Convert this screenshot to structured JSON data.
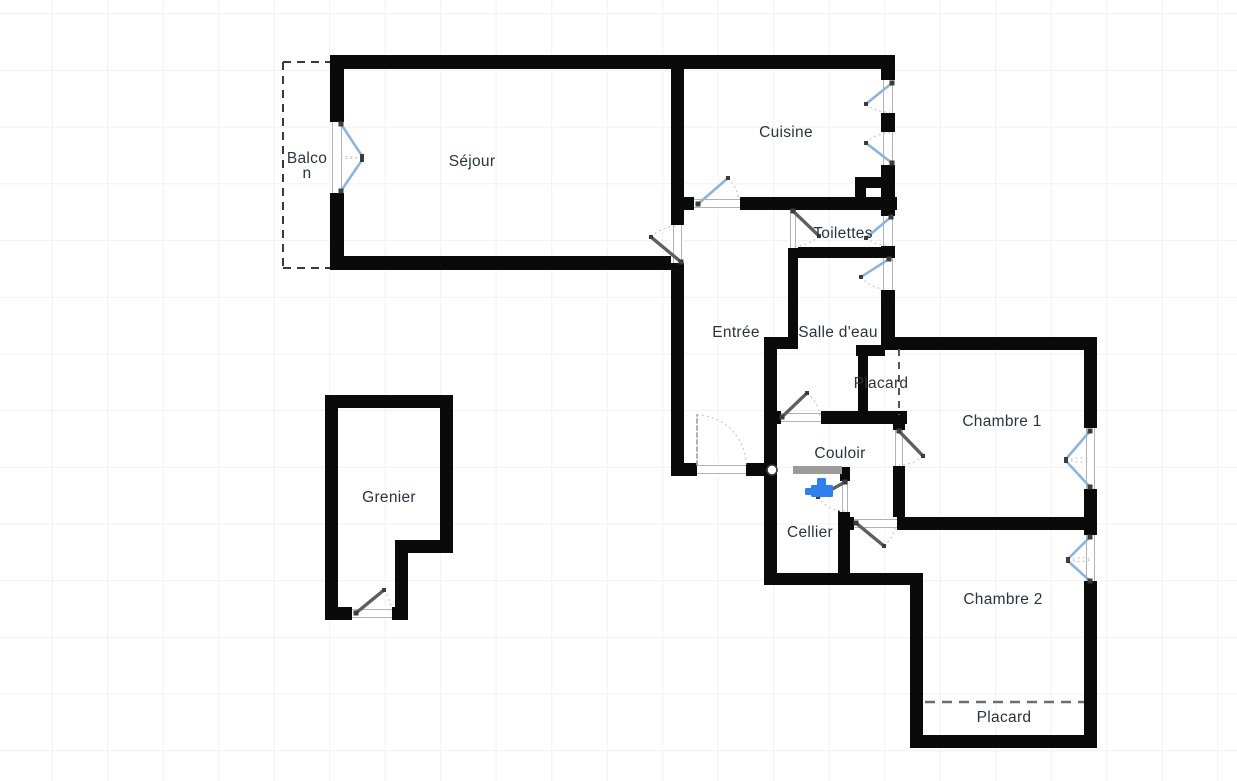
{
  "canvas": {
    "width": 1237,
    "height": 781,
    "background": "#ffffff",
    "grid_color": "#f1f1f1"
  },
  "colors": {
    "wall": "#0a0a0a",
    "door_leaf": "#5c6064",
    "window_leaf": "#8fb3dc",
    "entry_leaf": "#9aa0a6",
    "arc": "#c9c9c9",
    "opening_frame": "#b3b3b3",
    "label": "#28343f",
    "passage_bar": "#9b9b9b",
    "fixture_blue": "#2f80ed",
    "dashed": "#3a3a3a",
    "placard_dash": "#6e6e6e"
  },
  "rooms": [
    {
      "id": "balcon",
      "lines": [
        "Balco",
        "n"
      ],
      "x": 307,
      "y": 163
    },
    {
      "id": "sejour",
      "lines": [
        "Séjour"
      ],
      "x": 472,
      "y": 166
    },
    {
      "id": "cuisine",
      "lines": [
        "Cuisine"
      ],
      "x": 786,
      "y": 137
    },
    {
      "id": "toilettes",
      "lines": [
        "Toilettes"
      ],
      "x": 843,
      "y": 238
    },
    {
      "id": "entree",
      "lines": [
        "Entrée"
      ],
      "x": 736,
      "y": 337
    },
    {
      "id": "salle-d-eau",
      "lines": [
        "Salle d'eau"
      ],
      "x": 838,
      "y": 337
    },
    {
      "id": "placard-1",
      "lines": [
        "Placard"
      ],
      "x": 881,
      "y": 388
    },
    {
      "id": "chambre-1",
      "lines": [
        "Chambre 1"
      ],
      "x": 1002,
      "y": 426
    },
    {
      "id": "couloir",
      "lines": [
        "Couloir"
      ],
      "x": 840,
      "y": 458
    },
    {
      "id": "cellier",
      "lines": [
        "Cellier"
      ],
      "x": 810,
      "y": 537
    },
    {
      "id": "chambre-2",
      "lines": [
        "Chambre 2"
      ],
      "x": 1003,
      "y": 604
    },
    {
      "id": "grenier",
      "lines": [
        "Grenier"
      ],
      "x": 389,
      "y": 502
    },
    {
      "id": "placard-2",
      "lines": [
        "Placard"
      ],
      "x": 1004,
      "y": 722
    }
  ],
  "walls": [
    {
      "x": 330,
      "y": 55,
      "w": 565,
      "h": 14
    },
    {
      "x": 330,
      "y": 55,
      "w": 14,
      "h": 69
    },
    {
      "x": 330,
      "y": 191,
      "w": 14,
      "h": 79
    },
    {
      "x": 330,
      "y": 256,
      "w": 354,
      "h": 14
    },
    {
      "x": 671,
      "y": 55,
      "w": 13,
      "h": 172
    },
    {
      "x": 671,
      "y": 261,
      "w": 13,
      "h": 215
    },
    {
      "x": 671,
      "y": 463,
      "w": 106,
      "h": 13
    },
    {
      "x": 881,
      "y": 55,
      "w": 14,
      "h": 295
    },
    {
      "x": 684,
      "y": 197,
      "w": 213,
      "h": 13
    },
    {
      "x": 855,
      "y": 177,
      "w": 30,
      "h": 11
    },
    {
      "x": 855,
      "y": 177,
      "w": 11,
      "h": 33
    },
    {
      "x": 788,
      "y": 247,
      "w": 97,
      "h": 11
    },
    {
      "x": 788,
      "y": 210,
      "w": 10,
      "h": 130
    },
    {
      "x": 764,
      "y": 337,
      "w": 34,
      "h": 12
    },
    {
      "x": 764,
      "y": 343,
      "w": 13,
      "h": 242
    },
    {
      "x": 777,
      "y": 411,
      "w": 130,
      "h": 13
    },
    {
      "x": 858,
      "y": 347,
      "w": 10,
      "h": 70
    },
    {
      "x": 856,
      "y": 345,
      "w": 29,
      "h": 11
    },
    {
      "x": 883,
      "y": 337,
      "w": 214,
      "h": 13
    },
    {
      "x": 893,
      "y": 417,
      "w": 12,
      "h": 113
    },
    {
      "x": 1084,
      "y": 337,
      "w": 13,
      "h": 411
    },
    {
      "x": 897,
      "y": 517,
      "w": 200,
      "h": 13
    },
    {
      "x": 846,
      "y": 517,
      "w": 8,
      "h": 13
    },
    {
      "x": 840,
      "y": 467,
      "w": 10,
      "h": 16
    },
    {
      "x": 838,
      "y": 510,
      "w": 12,
      "h": 63
    },
    {
      "x": 764,
      "y": 573,
      "w": 159,
      "h": 12
    },
    {
      "x": 910,
      "y": 573,
      "w": 13,
      "h": 175
    },
    {
      "x": 910,
      "y": 735,
      "w": 187,
      "h": 13
    },
    {
      "x": 325,
      "y": 395,
      "w": 128,
      "h": 13
    },
    {
      "x": 325,
      "y": 395,
      "w": 13,
      "h": 225
    },
    {
      "x": 440,
      "y": 395,
      "w": 13,
      "h": 158
    },
    {
      "x": 395,
      "y": 540,
      "w": 58,
      "h": 13
    },
    {
      "x": 395,
      "y": 540,
      "w": 13,
      "h": 80
    },
    {
      "x": 325,
      "y": 607,
      "w": 73,
      "h": 13
    }
  ],
  "openings": [
    {
      "name": "balcony-door-opening",
      "x": 330,
      "y": 122,
      "w": 14,
      "h": 71,
      "dir": "v"
    },
    {
      "name": "sejour-door-opening",
      "x": 671,
      "y": 225,
      "w": 13,
      "h": 38,
      "dir": "v"
    },
    {
      "name": "entry-door-opening",
      "x": 697,
      "y": 463,
      "w": 49,
      "h": 13,
      "dir": "h"
    },
    {
      "name": "cuisine-door-opening",
      "x": 694,
      "y": 197,
      "w": 46,
      "h": 13,
      "dir": "h"
    },
    {
      "name": "toilettes-door-opening",
      "x": 788,
      "y": 210,
      "w": 10,
      "h": 38,
      "dir": "v"
    },
    {
      "name": "couloir-door-opening",
      "x": 781,
      "y": 411,
      "w": 40,
      "h": 13,
      "dir": "h"
    },
    {
      "name": "cellier-door-opening",
      "x": 840,
      "y": 481,
      "w": 10,
      "h": 31,
      "dir": "v"
    },
    {
      "name": "chambre1-door-opening",
      "x": 893,
      "y": 430,
      "w": 12,
      "h": 36,
      "dir": "v"
    },
    {
      "name": "chambre2-door-opening",
      "x": 854,
      "y": 517,
      "w": 43,
      "h": 13,
      "dir": "h"
    },
    {
      "name": "grenier-door-opening",
      "x": 352,
      "y": 607,
      "w": 40,
      "h": 13,
      "dir": "h"
    },
    {
      "name": "cuisine-window-1-opening",
      "x": 881,
      "y": 80,
      "w": 14,
      "h": 33,
      "dir": "v"
    },
    {
      "name": "cuisine-window-2-opening",
      "x": 881,
      "y": 132,
      "w": 14,
      "h": 33,
      "dir": "v"
    },
    {
      "name": "toilettes-window-opening",
      "x": 881,
      "y": 216,
      "w": 14,
      "h": 30,
      "dir": "v"
    },
    {
      "name": "salle-d-eau-window-opening",
      "x": 881,
      "y": 258,
      "w": 14,
      "h": 32,
      "dir": "v"
    },
    {
      "name": "chambre1-window-opening",
      "x": 1084,
      "y": 428,
      "w": 13,
      "h": 61,
      "dir": "v"
    },
    {
      "name": "chambre2-window-opening",
      "x": 1084,
      "y": 535,
      "w": 13,
      "h": 46,
      "dir": "v"
    }
  ],
  "doors": [
    {
      "name": "sejour-door",
      "kind": "door",
      "leaf": [
        681,
        262,
        651,
        237
      ],
      "arc": [
        651,
        237,
        39,
        1,
        678,
        226
      ]
    },
    {
      "name": "entry-door",
      "kind": "entry",
      "leaf": [
        697,
        465,
        697,
        415
      ],
      "arc": [
        697,
        415,
        50,
        1,
        746,
        465
      ]
    },
    {
      "name": "cuisine-door",
      "kind": "window",
      "leaf": [
        698,
        204,
        728,
        178
      ],
      "arc": [
        728,
        178,
        38,
        1,
        739,
        200
      ]
    },
    {
      "name": "toilettes-door",
      "kind": "door",
      "leaf": [
        793,
        211,
        819,
        236
      ],
      "arc": [
        819,
        236,
        36,
        1,
        793,
        246
      ]
    },
    {
      "name": "couloir-door",
      "kind": "door",
      "leaf": [
        782,
        417,
        807,
        393
      ],
      "arc": [
        807,
        393,
        35,
        1,
        820,
        416
      ]
    },
    {
      "name": "cellier-door",
      "kind": "door",
      "leaf": [
        845,
        482,
        818,
        497
      ],
      "arc": [
        818,
        497,
        31,
        0,
        845,
        511
      ]
    },
    {
      "name": "chambre1-door",
      "kind": "door",
      "leaf": [
        899,
        431,
        923,
        456
      ],
      "arc": [
        923,
        456,
        35,
        1,
        899,
        465
      ]
    },
    {
      "name": "chambre2-door",
      "kind": "door",
      "leaf": [
        856,
        523,
        884,
        546
      ],
      "arc": [
        884,
        546,
        36,
        0,
        896,
        524
      ]
    },
    {
      "name": "grenier-door",
      "kind": "door",
      "leaf": [
        356,
        613,
        384,
        590
      ],
      "arc": [
        384,
        590,
        37,
        1,
        391,
        611
      ]
    },
    {
      "name": "cuisine-window-1",
      "kind": "window",
      "leaf": [
        892,
        83,
        866,
        104
      ],
      "arc": [
        866,
        104,
        33,
        0,
        890,
        112
      ]
    },
    {
      "name": "cuisine-window-2",
      "kind": "window",
      "leaf": [
        892,
        163,
        866,
        143
      ],
      "arc": [
        866,
        143,
        33,
        1,
        890,
        133
      ]
    },
    {
      "name": "toilettes-window",
      "kind": "window",
      "leaf": [
        891,
        217,
        866,
        238
      ],
      "arc": [
        866,
        238,
        33,
        0,
        889,
        245
      ]
    },
    {
      "name": "salle-d-eau-window",
      "kind": "window",
      "leaf": [
        889,
        259,
        861,
        277
      ],
      "arc": [
        861,
        277,
        33,
        0,
        887,
        289
      ]
    },
    {
      "name": "balcony-door-leaf-top",
      "kind": "window",
      "leaf": [
        341,
        124,
        362,
        156
      ],
      "arc": [
        362,
        156,
        38,
        1,
        341,
        158
      ]
    },
    {
      "name": "balcony-door-leaf-bottom",
      "kind": "window",
      "leaf": [
        341,
        191,
        362,
        160
      ],
      "arc": [
        362,
        160,
        38,
        0,
        341,
        157
      ]
    },
    {
      "name": "chambre1-window-leaf-top",
      "kind": "window",
      "leaf": [
        1090,
        431,
        1066,
        459
      ],
      "arc": [
        1066,
        459,
        37,
        0,
        1090,
        461
      ]
    },
    {
      "name": "chambre1-window-leaf-bottom",
      "kind": "window",
      "leaf": [
        1090,
        487,
        1066,
        461
      ],
      "arc": [
        1066,
        461,
        36,
        1,
        1090,
        459
      ]
    },
    {
      "name": "chambre2-window-leaf-top",
      "kind": "window",
      "leaf": [
        1090,
        537,
        1068,
        559
      ],
      "arc": [
        1068,
        559,
        31,
        0,
        1090,
        560
      ]
    },
    {
      "name": "chambre2-window-leaf-bottom",
      "kind": "window",
      "leaf": [
        1090,
        581,
        1068,
        561
      ],
      "arc": [
        1068,
        561,
        30,
        1,
        1090,
        559
      ]
    }
  ],
  "dashed_lines": [
    {
      "name": "balcon-outline-top",
      "x1": 283,
      "y1": 62,
      "x2": 330,
      "y2": 62,
      "dash": "8 6",
      "w": 2,
      "color": "#3a3a3a"
    },
    {
      "name": "balcon-outline-left",
      "x1": 283,
      "y1": 62,
      "x2": 283,
      "y2": 268,
      "dash": "8 6",
      "w": 2,
      "color": "#3a3a3a"
    },
    {
      "name": "balcon-outline-bottom",
      "x1": 283,
      "y1": 268,
      "x2": 330,
      "y2": 268,
      "dash": "8 6",
      "w": 2,
      "color": "#3a3a3a"
    },
    {
      "name": "placard-1-divider",
      "x1": 899,
      "y1": 349,
      "x2": 899,
      "y2": 415,
      "dash": "7 6",
      "w": 2,
      "color": "#565656"
    },
    {
      "name": "placard-2-divider",
      "x1": 925,
      "y1": 702,
      "x2": 1084,
      "y2": 702,
      "dash": "10 7",
      "w": 2.5,
      "color": "#6e6e6e"
    }
  ],
  "extras": {
    "passage_bar": {
      "name": "couloir-cellier-passage",
      "x": 793,
      "y": 466,
      "w": 49,
      "h": 8
    },
    "hinge_circle": {
      "name": "door-pivot-circle",
      "cx": 772,
      "cy": 470,
      "r": 5
    }
  },
  "fixtures": [
    {
      "name": "water-tap-icon",
      "x": 805,
      "y": 478,
      "color": "#2f80ed"
    }
  ]
}
